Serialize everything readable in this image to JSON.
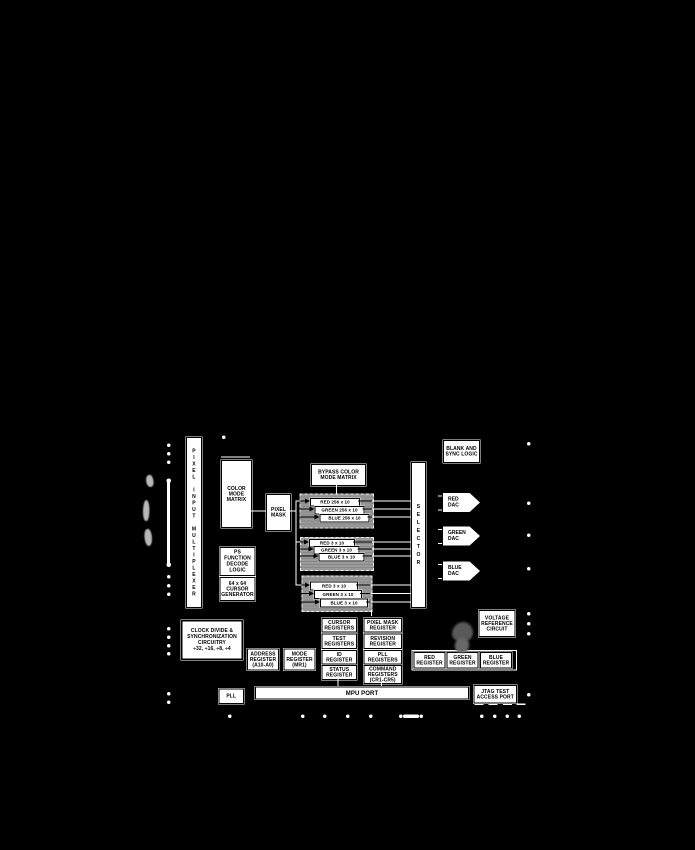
{
  "colors": {
    "background": "#000000",
    "box_fill": "#ffffff",
    "box_text": "#000000",
    "palette_group_fill": "#919191",
    "stain": "#595959"
  },
  "blocks": {
    "pixel_input_multiplexer": "PIXEL INPUT MULTIPLEXER",
    "color_mode_matrix": "COLOR\nMODE\nMATRIX",
    "pixel_mask": "PIXEL\nMASK",
    "bypass_color_mode_matrix": "BYPASS COLOR\nMODE MATRIX",
    "selector": "SELECTOR",
    "blank_and_sync_logic": "BLANK AND\nSYNC LOGIC",
    "red_dac": "RED\nDAC",
    "green_dac": "GREEN\nDAC",
    "blue_dac": "BLUE\nDAC",
    "ps_function_decode_logic": "PS\nFUNCTION\nDECODE\nLOGIC",
    "cursor_generator": "64 x 64\nCURSOR\nGENERATOR",
    "clock_divide": "CLOCK DIVIDE &\nSYNCHRONIZATION\nCIRCUITRY\n÷32, ÷16, ÷8, ÷4",
    "address_register": "ADDRESS\nREGISTER\n(A10-A0)",
    "mode_register": "MODE\nREGISTER\n(MR1)",
    "cursor_registers": "CURSOR\nREGISTERS",
    "test_registers": "TEST\nREGISTERS",
    "id_register": "ID\nREGISTER",
    "status_register": "STATUS\nREGISTER",
    "pixel_mask_register": "PIXEL MASK\nREGISTER",
    "revision_register": "REVISION\nREGISTER",
    "pll_registers": "PLL\nREGISTERS",
    "command_registers": "COMMAND\nREGISTERS\n(CR1-CR5)",
    "red_register": "RED\nREGISTER",
    "green_register": "GREEN\nREGISTER",
    "blue_register": "BLUE\nREGISTER",
    "voltage_reference_circuit": "VOLTAGE\nREFERENCE\nCIRCUIT",
    "pll": "PLL",
    "mpu_port": "MPU PORT",
    "jtag_test_access_port": "JTAG TEST\nACCESS PORT"
  },
  "palette_groups": [
    {
      "id": "color-palette-256",
      "registers": [
        "RED 256 x 10",
        "GREEN 256 x 10",
        "BLUE 256 x 10"
      ]
    },
    {
      "id": "overlay-palette",
      "registers": [
        "RED 3 x 10",
        "GREEN 3 x 10",
        "BLUE 3 x 10"
      ]
    },
    {
      "id": "cursor-palette",
      "registers": [
        "RED 3 x 10",
        "GREEN 3 x 10",
        "BLUE 3 x 10"
      ]
    }
  ]
}
